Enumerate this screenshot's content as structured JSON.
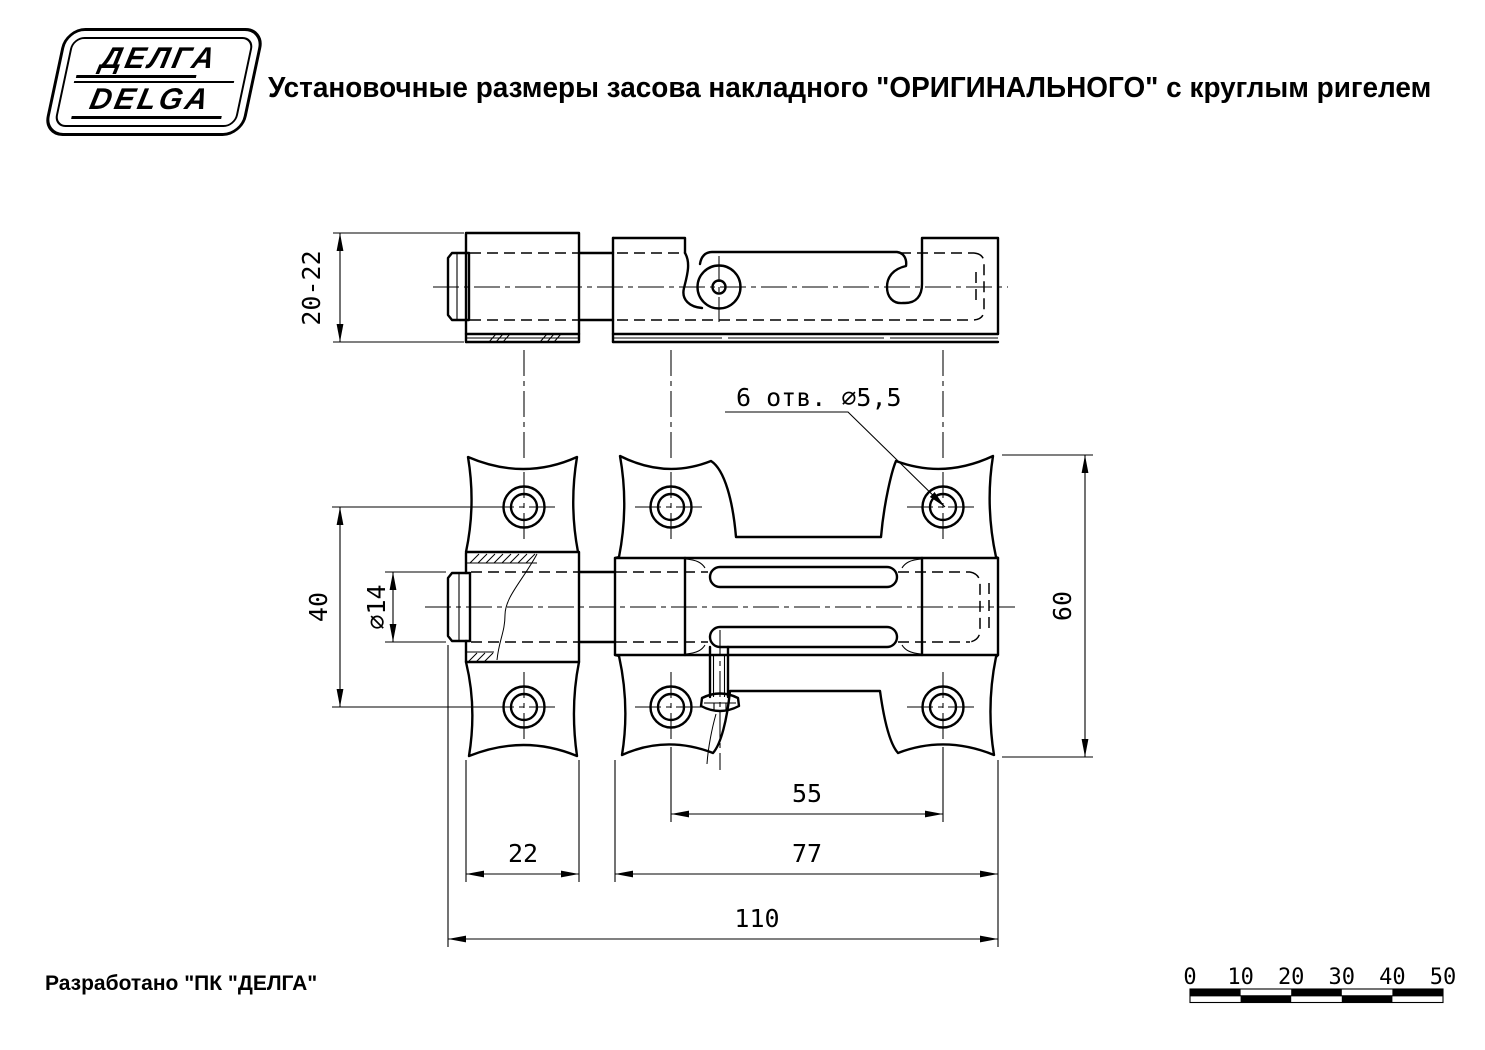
{
  "title": "Установочные размеры засова накладного \"ОРИГИНАЛЬНОГО\" с круглым ригелем",
  "logo": {
    "line1": "ДЕЛГА",
    "line2": "DELGA"
  },
  "footer": {
    "text": "Разработано \"ПК \"ДЕЛГА\""
  },
  "drawing": {
    "labels": {
      "height_range": "20-22",
      "vertical_hole_spacing": "40",
      "bolt_diameter": "∅14",
      "plate_height": "60",
      "horizontal_hole_spacing": "55",
      "keeper_width": "22",
      "plate_width": "77",
      "overall_length": "110",
      "holes_note": "6 отв. ∅5,5"
    }
  },
  "scale_bar": {
    "labels": [
      "0",
      "10",
      "20",
      "30",
      "40",
      "50"
    ]
  }
}
